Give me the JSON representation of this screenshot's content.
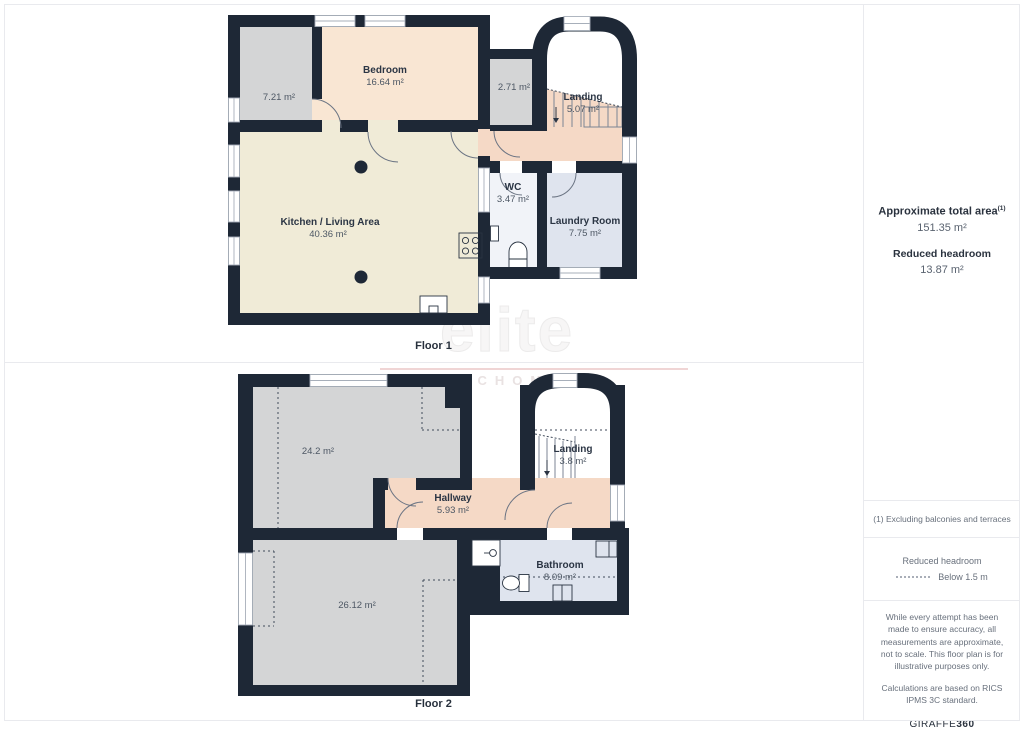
{
  "watermark": {
    "line1": "elite",
    "line2": "NIERUCHOMOŚCI"
  },
  "colors": {
    "wall": "#1e2836",
    "bedroom_fill": "#f9e6d3",
    "kitchen_fill": "#f0ebd7",
    "gray_room_fill": "#d4d5d6",
    "hallway_fill": "#f5d9c6",
    "bathroom_fill": "#dfe4ee",
    "wc_fill": "#f1f3f8",
    "divider": "#e9eaee"
  },
  "floors": {
    "floor1": {
      "label": "Floor 1",
      "rooms": {
        "bedroom": {
          "name": "Bedroom",
          "area": "16.64 m²"
        },
        "side_room": {
          "area": "7.21 m²"
        },
        "small_room": {
          "area": "2.71 m²"
        },
        "landing": {
          "name": "Landing",
          "area": "5.07 m²"
        },
        "kitchen_living": {
          "name": "Kitchen / Living Area",
          "area": "40.36 m²"
        },
        "wc": {
          "name": "WC",
          "area": "3.47 m²"
        },
        "laundry": {
          "name": "Laundry Room",
          "area": "7.75 m²"
        }
      }
    },
    "floor2": {
      "label": "Floor 2",
      "rooms": {
        "room_a": {
          "area": "24.2 m²"
        },
        "landing": {
          "name": "Landing",
          "area": "3.8 m²"
        },
        "hallway": {
          "name": "Hallway",
          "area": "5.93 m²"
        },
        "room_b": {
          "area": "26.12 m²"
        },
        "bathroom": {
          "name": "Bathroom",
          "area": "8.09 m²"
        }
      }
    }
  },
  "sidebar": {
    "total_area": {
      "title": "Approximate total area",
      "footnote_marker": "(1)",
      "value": "151.35 m²"
    },
    "reduced_headroom": {
      "title": "Reduced headroom",
      "value": "13.87 m²"
    },
    "footnote": "(1) Excluding balconies and terraces",
    "legend": {
      "title": "Reduced headroom",
      "label": "Below 1.5 m"
    },
    "disclaimer": "While every attempt has been made to ensure accuracy, all measurements are approximate, not to scale. This floor plan is for illustrative purposes only.",
    "standard_note": "Calculations are based on RICS IPMS 3C standard.",
    "brand": {
      "name": "GIRAFFE",
      "suffix": "360"
    }
  }
}
